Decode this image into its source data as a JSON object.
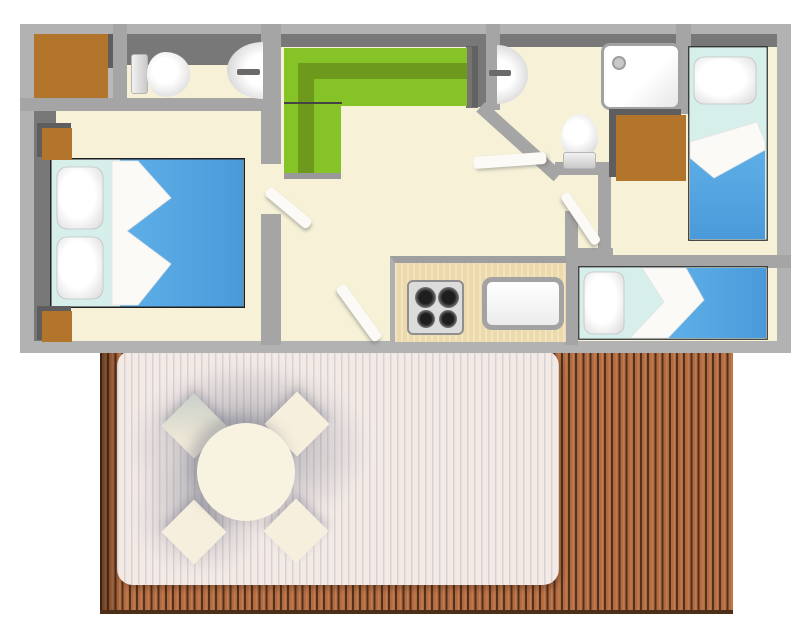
{
  "meta": {
    "type": "floor-plan",
    "subject": "mobile-home layout with terrace",
    "canvas": {
      "width": 800,
      "height": 632
    }
  },
  "colors": {
    "wall_light": "#b2b2b2",
    "wall_mid": "#a5a5a5",
    "wall_dark": "#787878",
    "shadow_dark": "#5e5e5e",
    "floor": "#f6f1d7",
    "alcove": "#b9b9b9",
    "wood": "#b3742c",
    "sofa_green": "#86c326",
    "sofa_green_dark": "#6d9a1d",
    "duvet_blue": "#55a5e3",
    "sheet_cyan": "#d6efeb",
    "counter_tan": "#eddaab",
    "steel": "#dcdcdc",
    "deck_brown": "#b16b41",
    "deck_light": "#c17b50",
    "deck_gap": "#52301b",
    "rug": "#f3eae6",
    "furn_cream": "#f6efde",
    "white": "#fbfaf6"
  },
  "scene": {
    "rooms": [
      {
        "name": "double-bedroom",
        "furniture": [
          "double-bed",
          "pillow",
          "pillow",
          "nightstand",
          "nightstand",
          "wardrobe-niche"
        ]
      },
      {
        "name": "wc-room",
        "furniture": [
          "toilet",
          "washbasin"
        ]
      },
      {
        "name": "living-room",
        "furniture": [
          "corner-sofa"
        ]
      },
      {
        "name": "kitchen",
        "furniture": [
          "counter",
          "hob-4-burners",
          "kitchen-sink"
        ]
      },
      {
        "name": "shower-room",
        "furniture": [
          "washbasin",
          "toilet",
          "shower-tray"
        ]
      },
      {
        "name": "single-bedroom-top",
        "furniture": [
          "single-bed",
          "pillow",
          "wardrobe"
        ]
      },
      {
        "name": "single-bedroom-bottom",
        "furniture": [
          "single-bed",
          "pillow"
        ]
      },
      {
        "name": "hallway",
        "furniture": [
          "door",
          "door",
          "door",
          "door"
        ]
      },
      {
        "name": "terrace",
        "furniture": [
          "wood-decking",
          "outdoor-rug",
          "round-table",
          "chair",
          "chair",
          "chair",
          "chair"
        ]
      }
    ]
  }
}
